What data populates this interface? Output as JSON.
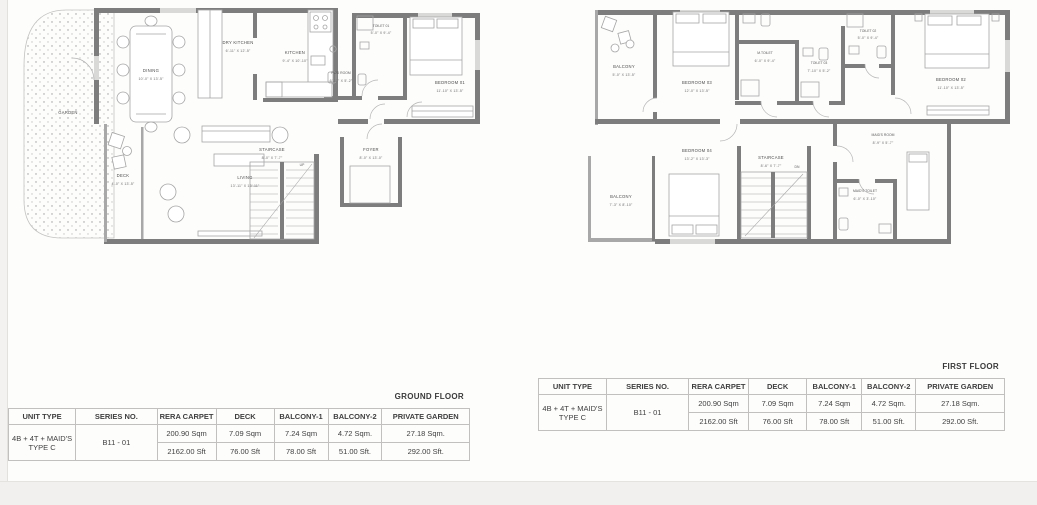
{
  "ground_floor": {
    "title": "GROUND FLOOR",
    "stair_direction": "UP",
    "rooms": [
      {
        "name": "GARDEN",
        "dims": ""
      },
      {
        "name": "DINING",
        "dims": "10'-0\" X 13'-5\""
      },
      {
        "name": "DRY KITCHEN",
        "dims": "6'-11\" X 12'-5\""
      },
      {
        "name": "KITCHEN",
        "dims": "9'-4\" X 10'-10\""
      },
      {
        "name": "PWD ROOM",
        "dims": "6'-11\" X 5'-2\""
      },
      {
        "name": "TOILET 01",
        "dims": "5'-0\" X 9'-4\""
      },
      {
        "name": "BEDROOM 01",
        "dims": "11'-10\" X 13'-5\""
      },
      {
        "name": "DECK",
        "dims": "4'-0\" X 13'-5\""
      },
      {
        "name": "LIVING",
        "dims": "13'-11\" X 13'-11\""
      },
      {
        "name": "STAIRCASE",
        "dims": "8'-0\" X 7'-7\""
      },
      {
        "name": "FOYER",
        "dims": "8'-0\" X 13'-0\""
      }
    ]
  },
  "first_floor": {
    "title": "FIRST FLOOR",
    "stair_direction": "DN",
    "rooms": [
      {
        "name": "BALCONY",
        "dims": "5'-0\" X 13'-5\""
      },
      {
        "name": "BEDROOM 03",
        "dims": "12'-0\" X 13'-5\""
      },
      {
        "name": "M.TOILET",
        "dims": "6'-0\" X 9'-4\""
      },
      {
        "name": "TOILET 03",
        "dims": "7'-10\" X 5'-2\""
      },
      {
        "name": "TOILET 02",
        "dims": "5'-0\" X 9'-4\""
      },
      {
        "name": "BEDROOM 02",
        "dims": "11'-10\" X 13'-5\""
      },
      {
        "name": "BEDROOM 04",
        "dims": "13'-2\" X 13'-3\""
      },
      {
        "name": "STAIRCASE",
        "dims": "8'-6\" X 7'-7\""
      },
      {
        "name": "MAID'S ROOM",
        "dims": "8'-9\" X 5'-7\""
      },
      {
        "name": "MAID'S TOILET",
        "dims": "6'-0\" X 3'-10\""
      },
      {
        "name": "BALCONY",
        "dims": "7'-3\" X 8'-10\""
      }
    ]
  },
  "area_table": {
    "headers": [
      "UNIT TYPE",
      "SERIES NO.",
      "RERA CARPET",
      "DECK",
      "BALCONY-1",
      "BALCONY-2",
      "PRIVATE GARDEN"
    ],
    "unit_type_line1": "4B + 4T + MAID'S",
    "unit_type_line2": "TYPE C",
    "series_no": "B11 - 01",
    "sqm_row": [
      "200.90 Sqm",
      "7.09 Sqm",
      "7.24 Sqm",
      "4.72 Sqm.",
      "27.18 Sqm."
    ],
    "sft_row": [
      "2162.00 Sft",
      "76.00 Sft",
      "78.00 Sft",
      "51.00 Sft.",
      "292.00 Sft."
    ]
  },
  "colors": {
    "wall": "#7d7d7d",
    "furniture_line": "#a5a5a5",
    "garden_dot": "#9a9a9a",
    "table_border": "#c1c0be",
    "text": "#3f3f3f"
  }
}
